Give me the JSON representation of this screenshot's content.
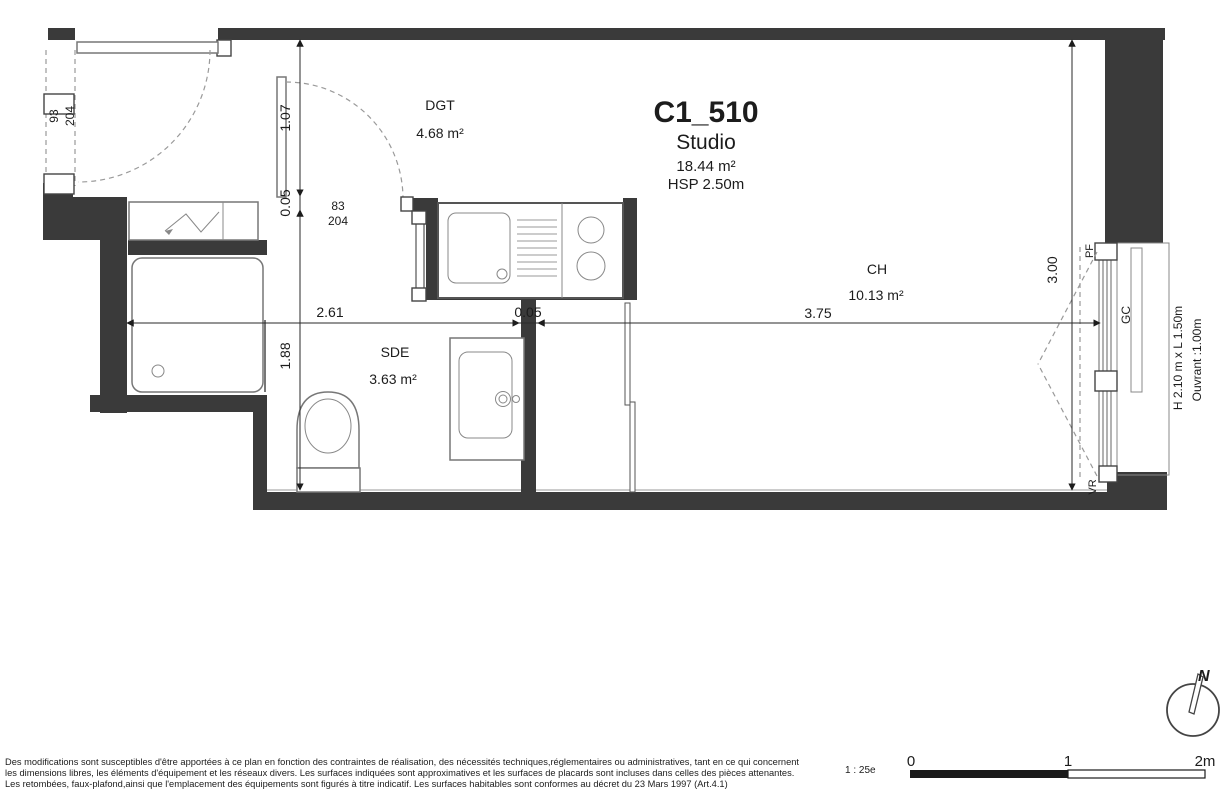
{
  "header": {
    "unit": "C1_510",
    "type": "Studio",
    "area": "18.44 m²",
    "hsp": "HSP 2.50m"
  },
  "rooms": {
    "dgt": {
      "name": "DGT",
      "area": "4.68 m²"
    },
    "sde": {
      "name": "SDE",
      "area": "3.63 m²"
    },
    "ch": {
      "name": "CH",
      "area": "10.13 m²"
    }
  },
  "dims": {
    "left_top": "1.07",
    "left_mid": "0.05",
    "left_bottom": "1.88",
    "h_left": "2.61",
    "h_mid": "0.05",
    "h_right": "3.75",
    "right": "3.00"
  },
  "doors": {
    "entry_width": "93",
    "entry_height": "204",
    "inner_width": "83",
    "inner_height": "204"
  },
  "window": {
    "pf": "PF",
    "gc": "GC",
    "vr": "VR",
    "size": "H 2.10 m x L 1.50m",
    "opening": "Ouvrant :1.00m"
  },
  "compass": {
    "label": "N"
  },
  "scale": {
    "ratio": "1 : 25e",
    "tick0": "0",
    "tick1": "1",
    "tick2": "2m"
  },
  "notes": {
    "line1": "Des modifications sont susceptibles d'être apportées à ce plan en fonction des contraintes de réalisation, des nécessités techniques,réglementaires ou administratives, tant en ce qui concernent",
    "line2": "les dimensions libres, les éléments d'équipement et les réseaux divers. Les surfaces indiquées sont approximatives et les surfaces de placards sont incluses dans celles des pièces attenantes.",
    "line3": "Les retombées, faux-plafond,ainsi que l'emplacement des équipements sont figurés à titre indicatif. Les surfaces habitables sont conformes au décret du 23 Mars 1997 (Art.4.1)"
  }
}
